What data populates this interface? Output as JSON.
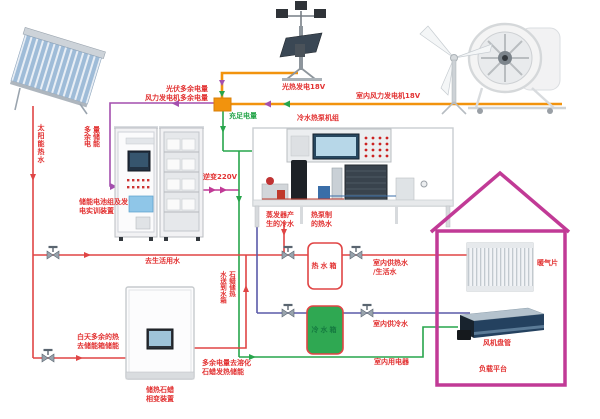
{
  "colors": {
    "hot_line": "#e04545",
    "cold_line": "#5a5aa8",
    "power_green": "#27a54b",
    "power_orange": "#f2930d",
    "power_purple": "#a44fae",
    "house_outline": "#c13a96",
    "label_red": "#e23232",
    "label_green": "#27a54b",
    "cold_tank_fill": "#2fa852",
    "cold_tank_text": "#157a40"
  },
  "labels": {
    "pv_surplus": "光伏多余电量",
    "wind_surplus": "风力发电机多余电量",
    "solar_thermal_18v": "光热发电18V",
    "indoor_wind_18v": "室内风力发电机18V",
    "sufficient_power": "充足电量",
    "heat_pump_unit": "冷水热泵机组",
    "surplus_storage_col1": "多余电",
    "surplus_storage_col2": "量储能",
    "inverter_220v": "逆变220V",
    "battery_device_line1": "储能电池组及发",
    "battery_device_line2": "电实训装置",
    "solar_hot_water": "太阳能热水",
    "to_domestic_water": "去生活用水",
    "evap_cold_line1": "蒸发器产",
    "evap_cold_line2": "生的冷水",
    "hp_hot_line1": "热泵制",
    "hp_hot_line2": "的热水",
    "hot_tank": "热水箱",
    "cold_tank": "冷水箱",
    "indoor_hot_water_line1": "室内供热水",
    "indoor_hot_water_line2": "/生活水",
    "indoor_cold_water": "室内供冷水",
    "indoor_appliances": "室内用电器",
    "day_surplus_line1": "白天多余的热",
    "day_surplus_line2": "去储能箱储能",
    "paraffin_return_col_left": "水送到水箱",
    "paraffin_return_col_right": "石蜡储热",
    "surplus_melt_line1": "多余电量去溶化",
    "surplus_melt_line2": "石蜡发热储能",
    "paraffin_device_line1": "储热石蜡",
    "paraffin_device_line2": "相变装置",
    "radiator": "暖气片",
    "fan_coil": "风机盘管",
    "load_platform": "负载平台"
  }
}
